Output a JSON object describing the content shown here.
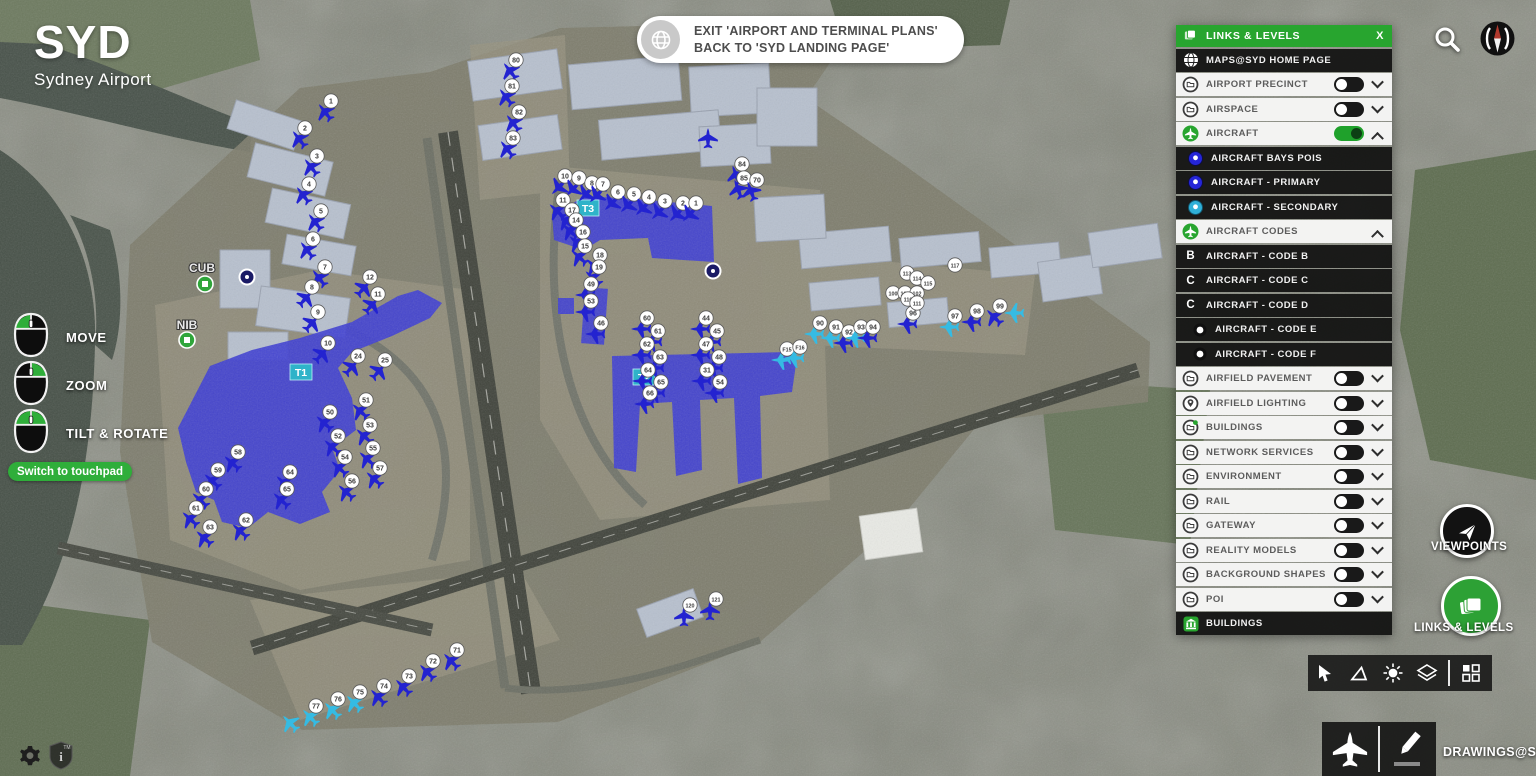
{
  "logo": {
    "title": "SYD",
    "subtitle": "Sydney Airport"
  },
  "exit_banner": {
    "line1": "EXIT 'AIRPORT AND TERMINAL PLANS'",
    "line2": "BACK TO 'SYD LANDING PAGE'"
  },
  "mouse_controls": {
    "items": [
      {
        "label": "MOVE",
        "buttons": "left"
      },
      {
        "label": "ZOOM",
        "buttons": "right"
      },
      {
        "label": "TILT & ROTATE",
        "buttons": "both"
      }
    ],
    "switch_label": "Switch to touchpad"
  },
  "panel": {
    "title": "LINKS & LEVELS",
    "close_label": "X",
    "rows": [
      {
        "label": "MAPS@SYD HOME PAGE",
        "style": "dark",
        "icon": "globe",
        "toggle": "none",
        "chevron": "none",
        "indent": 0
      },
      {
        "label": "AIRPORT PRECINCT",
        "style": "light",
        "icon": "folder",
        "toggle": "off",
        "chevron": "down",
        "indent": 0
      },
      {
        "label": "AIRSPACE",
        "style": "light",
        "icon": "folder",
        "toggle": "off",
        "chevron": "down",
        "indent": 0
      },
      {
        "label": "AIRCRAFT",
        "style": "light",
        "icon": "plane-green",
        "toggle": "on",
        "chevron": "up",
        "indent": 0
      },
      {
        "label": "AIRCRAFT BAYS POIS",
        "style": "dark",
        "icon": "dot-blue",
        "toggle": "none",
        "chevron": "none",
        "indent": 1
      },
      {
        "label": "AIRCRAFT - PRIMARY",
        "style": "dark",
        "icon": "dot-blue",
        "toggle": "none",
        "chevron": "none",
        "indent": 1
      },
      {
        "label": "AIRCRAFT - SECONDARY",
        "style": "dark",
        "icon": "dot-cyan",
        "toggle": "none",
        "chevron": "none",
        "indent": 1
      },
      {
        "label": "AIRCRAFT CODES",
        "style": "light",
        "icon": "plane-green",
        "toggle": "none",
        "chevron": "up",
        "indent": 0
      },
      {
        "label": "AIRCRAFT - CODE B",
        "style": "dark",
        "icon": "letter",
        "letter": "B",
        "toggle": "none",
        "chevron": "none",
        "indent": 2
      },
      {
        "label": "AIRCRAFT - CODE C",
        "style": "dark",
        "icon": "letter",
        "letter": "C",
        "toggle": "none",
        "chevron": "none",
        "indent": 2
      },
      {
        "label": "AIRCRAFT - CODE D",
        "style": "dark",
        "icon": "letter",
        "letter": "C",
        "toggle": "none",
        "chevron": "none",
        "indent": 2
      },
      {
        "label": "AIRCRAFT - CODE E",
        "style": "dark",
        "icon": "plane-mini",
        "toggle": "none",
        "chevron": "none",
        "indent": 2
      },
      {
        "label": "AIRCRAFT - CODE F",
        "style": "dark",
        "icon": "plane-mini",
        "toggle": "none",
        "chevron": "none",
        "indent": 2
      },
      {
        "label": "AIRFIELD PAVEMENT",
        "style": "light",
        "icon": "folder",
        "toggle": "off",
        "chevron": "down",
        "indent": 0
      },
      {
        "label": "AIRFIELD LIGHTING",
        "style": "light",
        "icon": "pin",
        "toggle": "off",
        "chevron": "down",
        "indent": 0
      },
      {
        "label": "BUILDINGS",
        "style": "light",
        "icon": "folder-greendot",
        "toggle": "off",
        "chevron": "down",
        "indent": 0
      },
      {
        "label": "NETWORK SERVICES",
        "style": "light",
        "icon": "folder",
        "toggle": "off",
        "chevron": "down",
        "indent": 0
      },
      {
        "label": "ENVIRONMENT",
        "style": "light",
        "icon": "folder",
        "toggle": "off",
        "chevron": "down",
        "indent": 0
      },
      {
        "label": "RAIL",
        "style": "light",
        "icon": "folder",
        "toggle": "off",
        "chevron": "down",
        "indent": 0
      },
      {
        "label": "GATEWAY",
        "style": "light",
        "icon": "folder",
        "toggle": "off",
        "chevron": "down",
        "indent": 0
      },
      {
        "label": "REALITY MODELS",
        "style": "light",
        "icon": "folder",
        "toggle": "off",
        "chevron": "down",
        "indent": 0
      },
      {
        "label": "BACKGROUND SHAPES",
        "style": "light",
        "icon": "folder",
        "toggle": "off",
        "chevron": "down",
        "indent": 0
      },
      {
        "label": "POI",
        "style": "light",
        "icon": "folder",
        "toggle": "off",
        "chevron": "down",
        "indent": 0
      },
      {
        "label": "BUILDINGS",
        "style": "dark",
        "icon": "building-green",
        "toggle": "none",
        "chevron": "none",
        "indent": 0
      }
    ]
  },
  "side_buttons": {
    "viewpoints_label": "VIEWPOINTS",
    "links_levels_label": "LINKS & LEVELS"
  },
  "bottom_toolbar": {
    "icons": [
      "select-arrow",
      "measure-angle",
      "sun",
      "layers-box",
      "grid"
    ]
  },
  "draw_bar": {
    "icons": [
      "airplane",
      "pencil"
    ],
    "drawings_label": "DRAWINGS@SYD"
  },
  "map": {
    "colors": {
      "green": "#28a52f",
      "terminal_blue": "#4040d2",
      "primary": "#2323d0",
      "secondary": "#35bbe3",
      "label_cyan": "#2fb3c9"
    },
    "terminals": [
      {
        "label": "T1",
        "x": 301,
        "y": 372
      },
      {
        "label": "T2",
        "x": 644,
        "y": 377
      },
      {
        "label": "T3",
        "x": 588,
        "y": 208
      }
    ],
    "pois": [
      {
        "label": "CUB",
        "x": 202,
        "y": 268,
        "cx": 205,
        "cy": 284
      },
      {
        "label": "NIB",
        "x": 187,
        "y": 325,
        "cx": 187,
        "cy": 340
      }
    ],
    "bay_circles": [
      {
        "x": 247,
        "y": 277
      },
      {
        "x": 713,
        "y": 271
      }
    ],
    "markers": [
      [
        "1",
        331,
        101,
        -38,
        "p",
        1
      ],
      [
        "2",
        305,
        128,
        -38,
        "p",
        1
      ],
      [
        "3",
        317,
        156,
        -38,
        "p",
        1
      ],
      [
        "4",
        309,
        184,
        -38,
        "p",
        1
      ],
      [
        "5",
        321,
        211,
        -38,
        "p",
        1
      ],
      [
        "6",
        313,
        239,
        -38,
        "p",
        1
      ],
      [
        "7",
        325,
        267,
        -38,
        "p",
        1
      ],
      [
        "8",
        312,
        287,
        42,
        "p",
        1
      ],
      [
        "9",
        318,
        312,
        42,
        "p",
        1
      ],
      [
        "10",
        328,
        343,
        42,
        "p",
        1
      ],
      [
        "12",
        370,
        277,
        42,
        "p",
        1
      ],
      [
        "11",
        378,
        294,
        42,
        "p",
        1
      ],
      [
        "24",
        358,
        356,
        42,
        "p",
        1
      ],
      [
        "25",
        385,
        360,
        42,
        "p",
        1
      ],
      [
        "50",
        330,
        412,
        -48,
        "p",
        1
      ],
      [
        "51",
        366,
        400,
        -48,
        "p",
        1
      ],
      [
        "52",
        338,
        436,
        -48,
        "p",
        1
      ],
      [
        "53",
        370,
        425,
        -48,
        "p",
        1
      ],
      [
        "54",
        345,
        457,
        -48,
        "p",
        1
      ],
      [
        "55",
        373,
        448,
        -48,
        "p",
        1
      ],
      [
        "56",
        352,
        481,
        -48,
        "p",
        1
      ],
      [
        "57",
        380,
        468,
        -48,
        "p",
        1
      ],
      [
        "58",
        238,
        452,
        -48,
        "p",
        1
      ],
      [
        "59",
        218,
        470,
        -48,
        "p",
        1
      ],
      [
        "60",
        206,
        489,
        -48,
        "p",
        1
      ],
      [
        "61",
        196,
        508,
        -48,
        "p",
        1
      ],
      [
        "62",
        246,
        520,
        -48,
        "p",
        1
      ],
      [
        "63",
        210,
        527,
        -48,
        "p",
        1
      ],
      [
        "64",
        290,
        472,
        -48,
        "p",
        1
      ],
      [
        "65",
        287,
        489,
        -48,
        "p",
        1
      ],
      [
        "71",
        457,
        650,
        -44,
        "p",
        1
      ],
      [
        "72",
        433,
        661,
        -44,
        "p",
        1
      ],
      [
        "73",
        409,
        676,
        -44,
        "p",
        1
      ],
      [
        "74",
        384,
        686,
        -44,
        "p",
        1
      ],
      [
        "75",
        360,
        692,
        -44,
        "s",
        1
      ],
      [
        "76",
        338,
        699,
        -44,
        "s",
        1
      ],
      [
        "77",
        316,
        706,
        -44,
        "s",
        1
      ],
      [
        "120",
        690,
        605,
        0,
        "p",
        1
      ],
      [
        "121",
        716,
        599,
        0,
        "p",
        1
      ],
      [
        "10",
        565,
        176,
        -135,
        "p",
        1
      ],
      [
        "9",
        579,
        178,
        -135,
        "p",
        1
      ],
      [
        "8",
        592,
        183,
        -135,
        "p",
        1
      ],
      [
        "7",
        603,
        184,
        -135,
        "p",
        1
      ],
      [
        "6",
        618,
        192,
        -135,
        "p",
        1
      ],
      [
        "5",
        634,
        194,
        -135,
        "p",
        1
      ],
      [
        "4",
        649,
        197,
        -135,
        "p",
        1
      ],
      [
        "3",
        665,
        201,
        -135,
        "p",
        1
      ],
      [
        "2",
        683,
        203,
        -135,
        "p",
        1
      ],
      [
        "1",
        696,
        203,
        -135,
        "p",
        1
      ],
      [
        "11",
        563,
        200,
        -48,
        "p",
        1
      ],
      [
        "17",
        572,
        210,
        -48,
        "p",
        1
      ],
      [
        "14",
        576,
        220,
        -48,
        "p",
        1
      ],
      [
        "16",
        583,
        232,
        -48,
        "p",
        1
      ],
      [
        "15",
        585,
        246,
        -48,
        "p",
        1
      ],
      [
        "18",
        600,
        255,
        -48,
        "p",
        1
      ],
      [
        "19",
        599,
        267,
        -48,
        "p",
        1
      ],
      [
        "49",
        591,
        284,
        -90,
        "p",
        1
      ],
      [
        "53",
        591,
        301,
        -90,
        "p",
        1
      ],
      [
        "46",
        601,
        323,
        -90,
        "p",
        1
      ],
      [
        "60",
        647,
        318,
        -90,
        "p",
        1
      ],
      [
        "61",
        658,
        331,
        -90,
        "p",
        1
      ],
      [
        "62",
        647,
        344,
        -90,
        "p",
        1
      ],
      [
        "63",
        660,
        357,
        -90,
        "p",
        1
      ],
      [
        "64",
        648,
        370,
        -90,
        "p",
        1
      ],
      [
        "65",
        661,
        382,
        -90,
        "p",
        1
      ],
      [
        "66",
        650,
        393,
        -90,
        "p",
        1
      ],
      [
        "44",
        706,
        318,
        -90,
        "p",
        1
      ],
      [
        "45",
        717,
        331,
        -90,
        "p",
        1
      ],
      [
        "47",
        706,
        344,
        -90,
        "p",
        1
      ],
      [
        "48",
        719,
        357,
        -90,
        "p",
        1
      ],
      [
        "31",
        707,
        370,
        -90,
        "p",
        1
      ],
      [
        "54",
        720,
        382,
        -90,
        "p",
        1
      ],
      [
        "F15",
        787,
        349,
        -90,
        "s",
        1
      ],
      [
        "F16",
        800,
        347,
        -90,
        "s",
        1
      ],
      [
        "90",
        820,
        323,
        -90,
        "s",
        1
      ],
      [
        "91",
        836,
        327,
        -90,
        "s",
        1
      ],
      [
        "92",
        849,
        332,
        -90,
        "p",
        1
      ],
      [
        "93",
        861,
        327,
        -90,
        "s",
        1
      ],
      [
        "94",
        873,
        327,
        -90,
        "p",
        1
      ],
      [
        "100",
        893,
        293,
        0,
        "p",
        0
      ],
      [
        "101",
        905,
        293,
        0,
        "p",
        0
      ],
      [
        "102",
        917,
        293,
        0,
        "p",
        0
      ],
      [
        "96",
        913,
        313,
        -90,
        "p",
        1
      ],
      [
        "97",
        955,
        316,
        -90,
        "s",
        1
      ],
      [
        "98",
        977,
        311,
        -90,
        "p",
        1
      ],
      [
        "99",
        1000,
        306,
        -45,
        "p",
        1
      ],
      [
        "110",
        908,
        299,
        0,
        "p",
        0
      ],
      [
        "111",
        917,
        303,
        0,
        "p",
        0
      ],
      [
        "113",
        907,
        273,
        0,
        "p",
        0
      ],
      [
        "114",
        917,
        278,
        0,
        "p",
        0
      ],
      [
        "115",
        928,
        283,
        0,
        "p",
        0
      ],
      [
        "117",
        955,
        265,
        0,
        "p",
        0
      ],
      [
        "80",
        516,
        60,
        -38,
        "p",
        1
      ],
      [
        "81",
        512,
        86,
        -38,
        "p",
        1
      ],
      [
        "82",
        519,
        112,
        -38,
        "p",
        1
      ],
      [
        "83",
        513,
        138,
        -38,
        "p",
        1
      ],
      [
        "84",
        742,
        164,
        -20,
        "p",
        1
      ],
      [
        "85",
        744,
        178,
        -20,
        "p",
        1
      ],
      [
        "70",
        757,
        180,
        -20,
        "p",
        1
      ],
      [
        "",
        714,
        127,
        0,
        "p",
        1
      ],
      [
        "",
        1020,
        302,
        -90,
        "s",
        1
      ],
      [
        "",
        296,
        712,
        -44,
        "s",
        1
      ]
    ]
  }
}
